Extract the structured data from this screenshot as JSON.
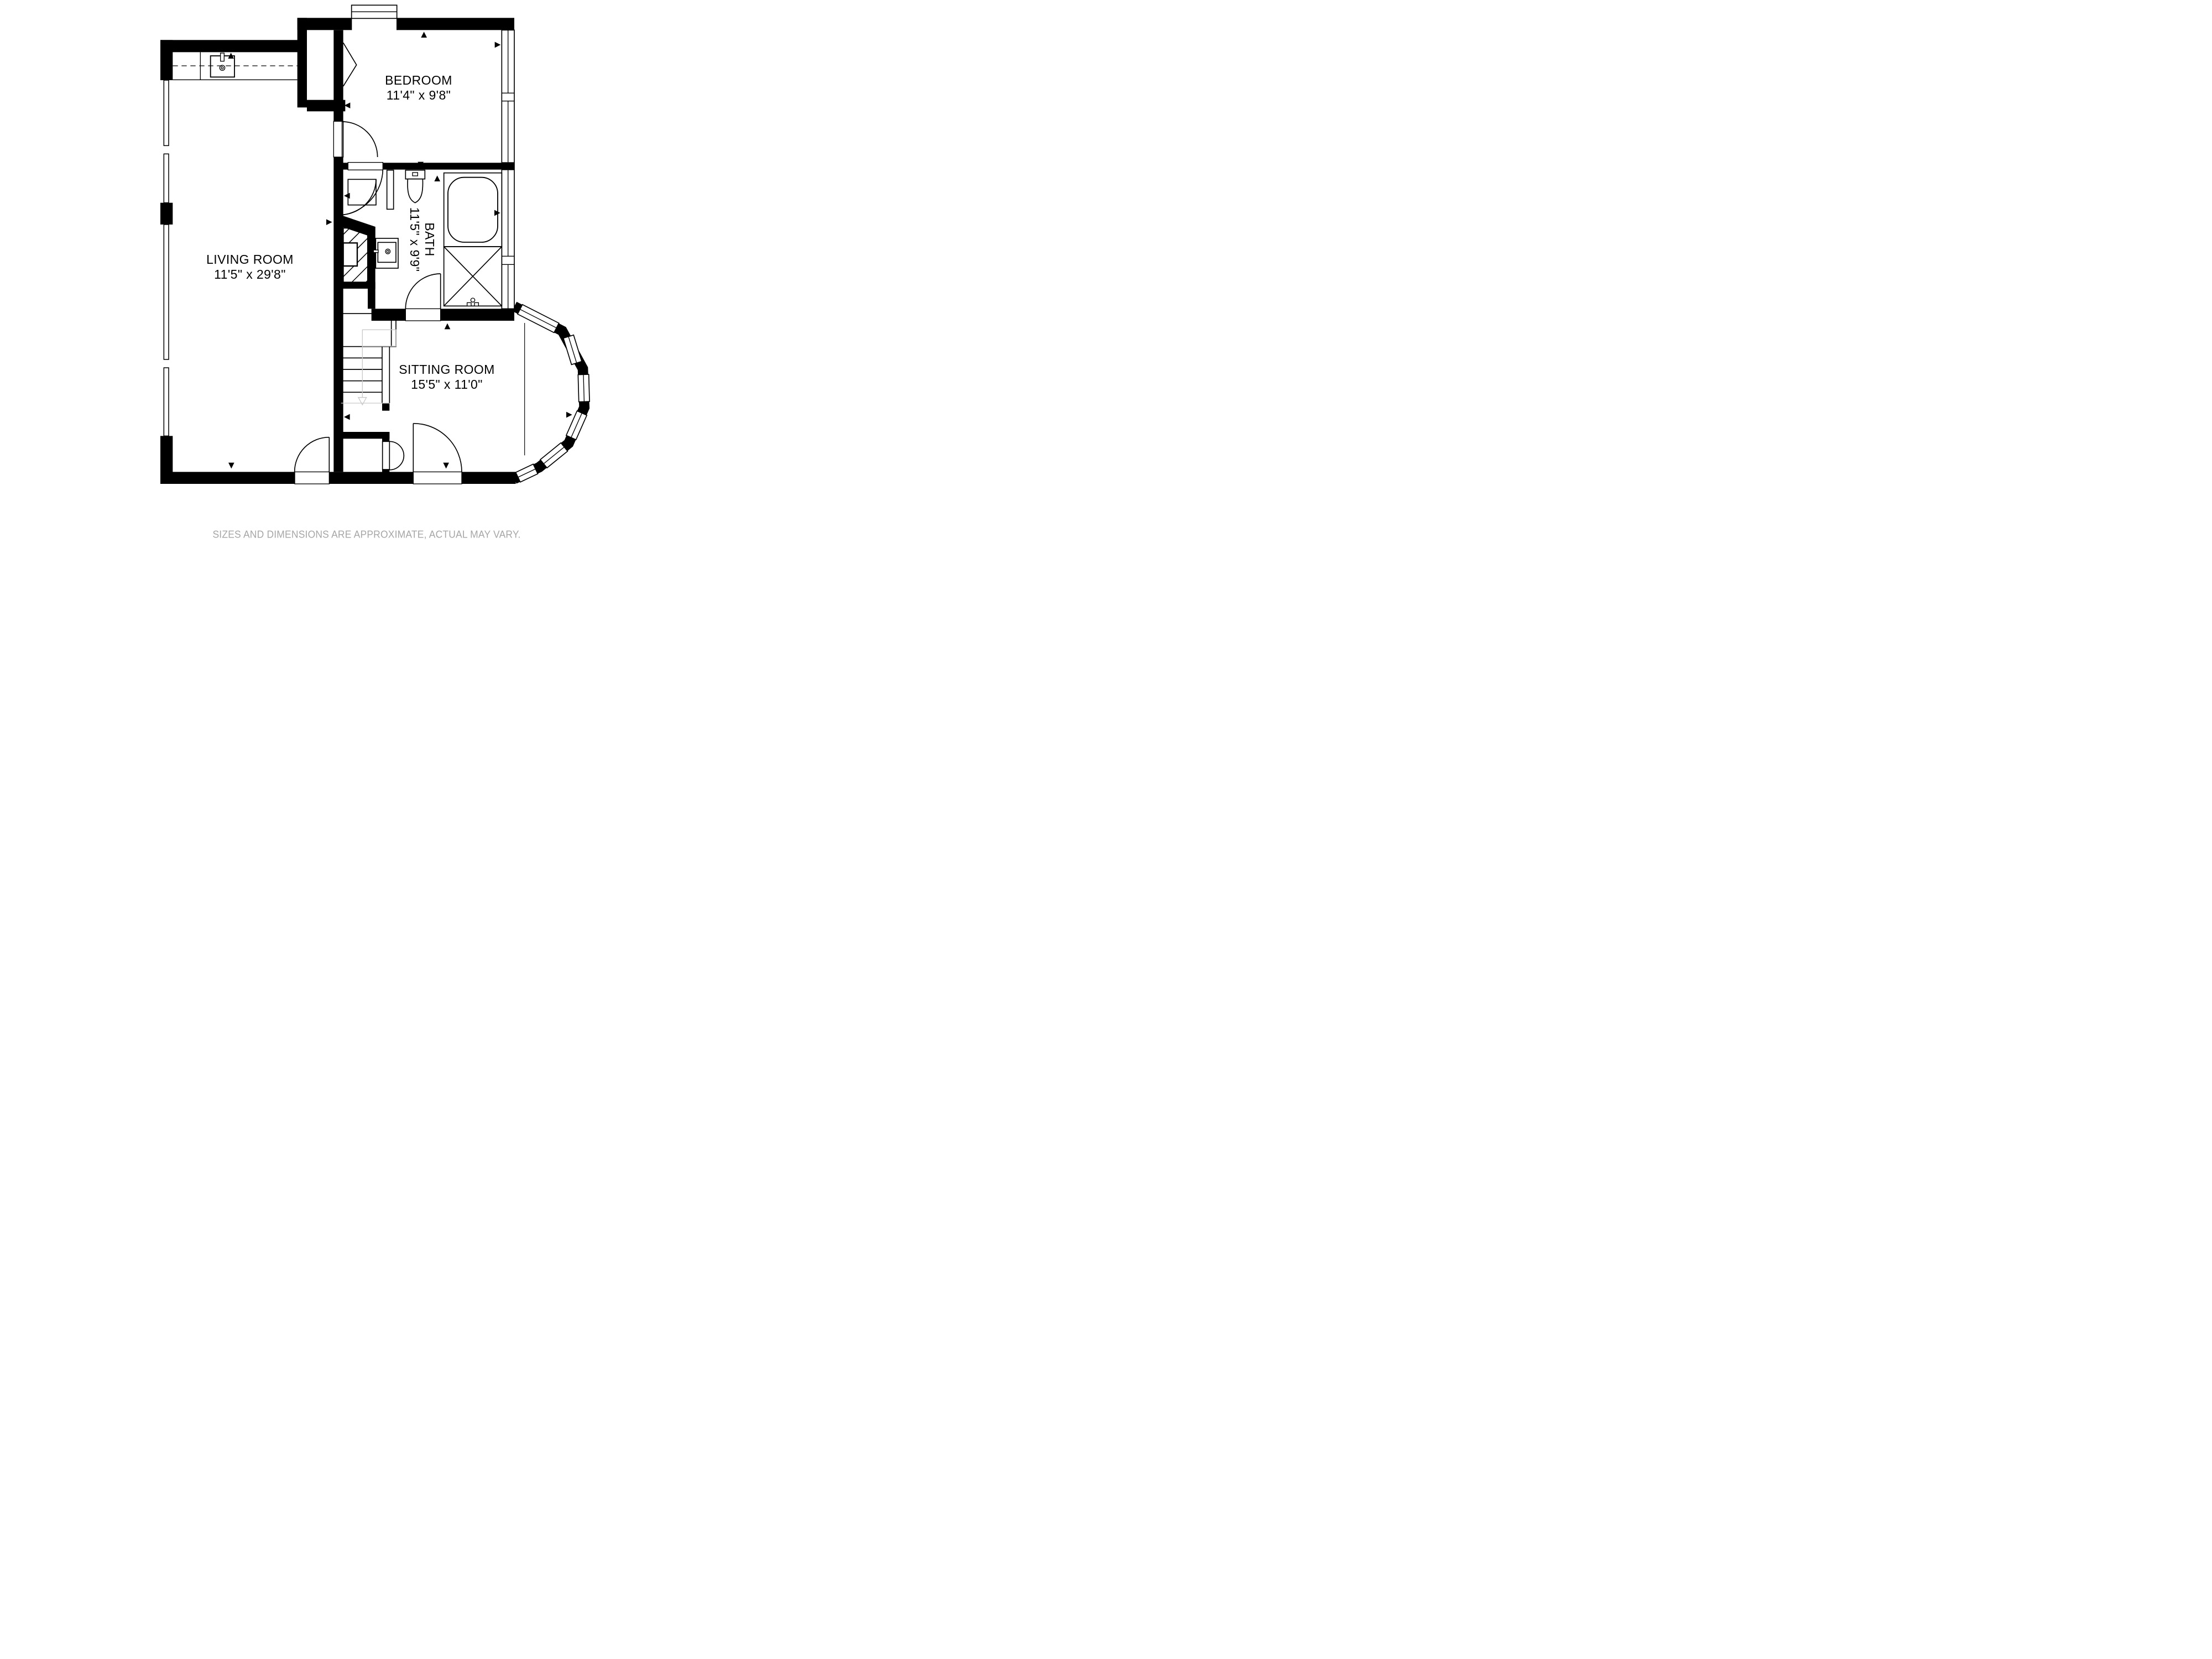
{
  "plan": {
    "type": "floor-plan",
    "background_color": "#ffffff",
    "wall_color": "#000000",
    "stair_guide_color": "#c9c9c9",
    "disclaimer_color": "#a6a6a6"
  },
  "rooms": [
    {
      "id": "bedroom",
      "name": "BEDROOM",
      "dimensions": "11'4\" x 9'8\""
    },
    {
      "id": "living-room",
      "name": "LIVING ROOM",
      "dimensions": "11'5\" x 29'8\""
    },
    {
      "id": "bath",
      "name": "BATH",
      "dimensions": "11'5\" x 9'9\"",
      "rotated": true
    },
    {
      "id": "sitting-room",
      "name": "SITTING ROOM",
      "dimensions": "15'5\" x 11'0\""
    }
  ],
  "disclaimer": "SIZES AND DIMENSIONS ARE APPROXIMATE, ACTUAL MAY VARY.",
  "fixtures": [
    "kitchen-sink-icon",
    "kitchen-counter",
    "overhead-cabinet-dashed-line",
    "toilet-icon",
    "bathtub-icon",
    "shower-icon",
    "vanity-sink-icon",
    "staircase",
    "stair-down-arrow-icon",
    "under-stair-void-hatch",
    "bay-window",
    "casement-windows",
    "swing-doors",
    "bifold-closet-doors",
    "dimension-marker-triangles"
  ]
}
